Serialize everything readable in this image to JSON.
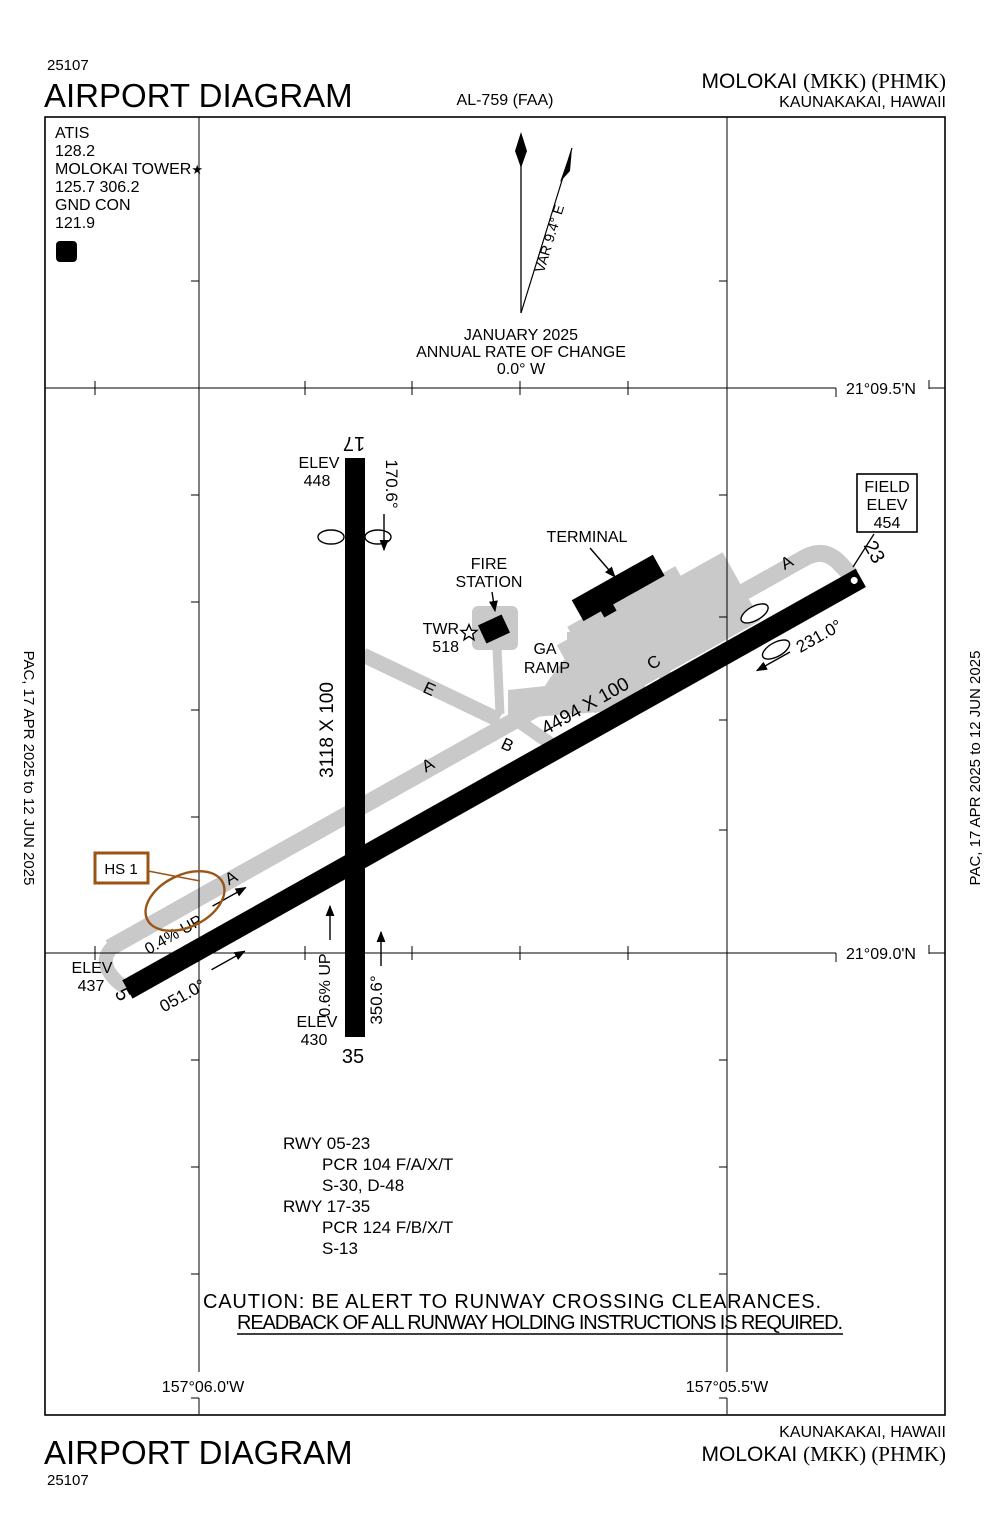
{
  "colors": {
    "twy": "#c9c9c9",
    "hs": "#9a5414"
  },
  "header": {
    "chart_number": "25107",
    "title": "AIRPORT DIAGRAM",
    "procedure_id": "AL-759 (FAA)",
    "airport_name": "MOLOKAI ",
    "airport_codes": "(MKK) (PHMK)",
    "city": "KAUNAKAKAI, HAWAII"
  },
  "comm_box": {
    "atis_label": "ATIS",
    "atis_freq": "128.2",
    "tower_label": "MOLOKAI TOWER",
    "tower_star": "★",
    "tower_freqs": "125.7  306.2",
    "gnd_label": "GND CON",
    "gnd_freq": "121.9",
    "clearance_symbol": "D"
  },
  "compass": {
    "variation": "VAR 9.4° E",
    "date": "JANUARY 2025",
    "rate_label": "ANNUAL RATE OF CHANGE",
    "rate_value": "0.0° W"
  },
  "grid": {
    "lat_top": "21°09.5'N",
    "lat_bottom": "21°09.0'N",
    "lon_left": "157°06.0'W",
    "lon_right": "157°05.5'W"
  },
  "field_elev_box": {
    "line1": "FIELD",
    "line2": "ELEV",
    "line3": "454"
  },
  "runways": {
    "rwy_0523": {
      "dimensions": "4494 X 100",
      "end5_number": "5",
      "end5_elev_label": "ELEV",
      "end5_elev": "437",
      "end5_heading": "051.0°",
      "slope": "0.4% UP",
      "end23_number": "23",
      "end23_heading": "231.0°"
    },
    "rwy_1735": {
      "dimensions": "3118 X 100",
      "end17_number": "17",
      "end17_elev_label": "ELEV",
      "end17_elev": "448",
      "end17_heading": "170.6°",
      "end35_number": "35",
      "end35_elev_label": "ELEV",
      "end35_elev": "430",
      "end35_heading": "350.6°",
      "slope": "0.6% UP"
    }
  },
  "taxiways": {
    "a": "A",
    "b": "B",
    "c": "C",
    "e": "E"
  },
  "facilities": {
    "terminal": "TERMINAL",
    "fire_line1": "FIRE",
    "fire_line2": "STATION",
    "twr_label": "TWR",
    "twr_elev": "518",
    "ga_line1": "GA",
    "ga_line2": "RAMP"
  },
  "hotspot": {
    "label": "HS 1"
  },
  "rwy_data": {
    "line1": "RWY 05-23",
    "line2": "PCR 104 F/A/X/T",
    "line3": "S-30, D-48",
    "line4": "RWY 17-35",
    "line5": "PCR 124 F/B/X/T",
    "line6": "S-13"
  },
  "caution": {
    "line1": "CAUTION: BE ALERT TO RUNWAY CROSSING CLEARANCES.",
    "line2": "READBACK OF ALL RUNWAY HOLDING INSTRUCTIONS IS REQUIRED."
  },
  "sidebar": {
    "effective_dates": "PAC,  17 APR 2025  to  12 JUN 2025"
  },
  "footer": {
    "title": "AIRPORT DIAGRAM",
    "chart_number": "25107",
    "city": "KAUNAKAKAI, HAWAII",
    "airport_name": "MOLOKAI ",
    "airport_codes": "(MKK) (PHMK)"
  }
}
